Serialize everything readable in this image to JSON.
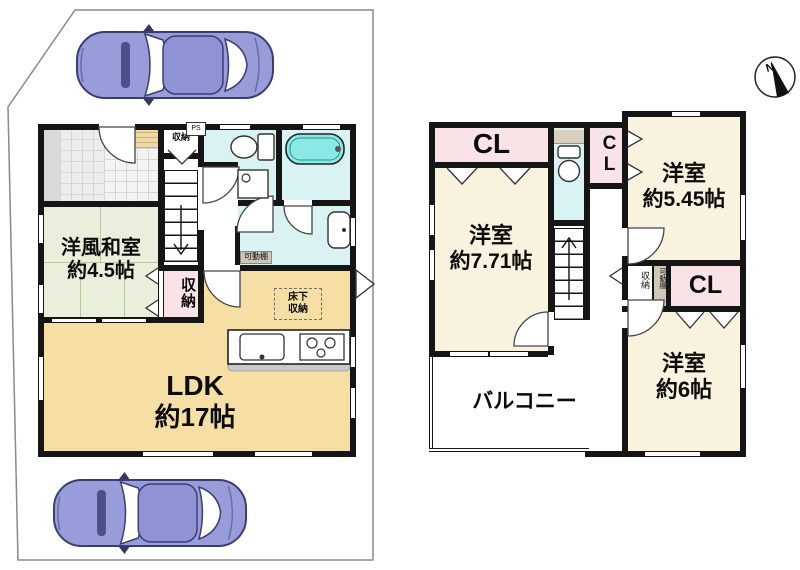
{
  "compass": {
    "north": "N"
  },
  "colors": {
    "wall": "#151515",
    "ldk_floor": "#f5dfa5",
    "tatami_room": "#e9efda",
    "western_room": "#f8f2df",
    "closet_pink": "#fae3e7",
    "water_area": "#d9f3f4",
    "bathtub": "#8ae9e4",
    "car_body": "#989cd9"
  },
  "f1": {
    "entrance_storage": "収納",
    "ps": "PS",
    "washitsu_name": "洋風和室",
    "washitsu_size": "約4.5帖",
    "side_storage": "収納",
    "movable_shelf": "可動棚",
    "underfloor_1": "床下",
    "underfloor_2": "収納",
    "ldk_name": "LDK",
    "ldk_size": "約17帖"
  },
  "f2": {
    "cl_top": "CL",
    "cl_mid": "CL",
    "cl_right": "CL",
    "room771_name": "洋室",
    "room771_size": "約7.71帖",
    "room545_name": "洋室",
    "room545_size": "約5.45帖",
    "room6_name": "洋室",
    "room6_size": "約6帖",
    "storage": "収納",
    "movable_shelf": "可動棚",
    "balcony": "バルコニー"
  }
}
